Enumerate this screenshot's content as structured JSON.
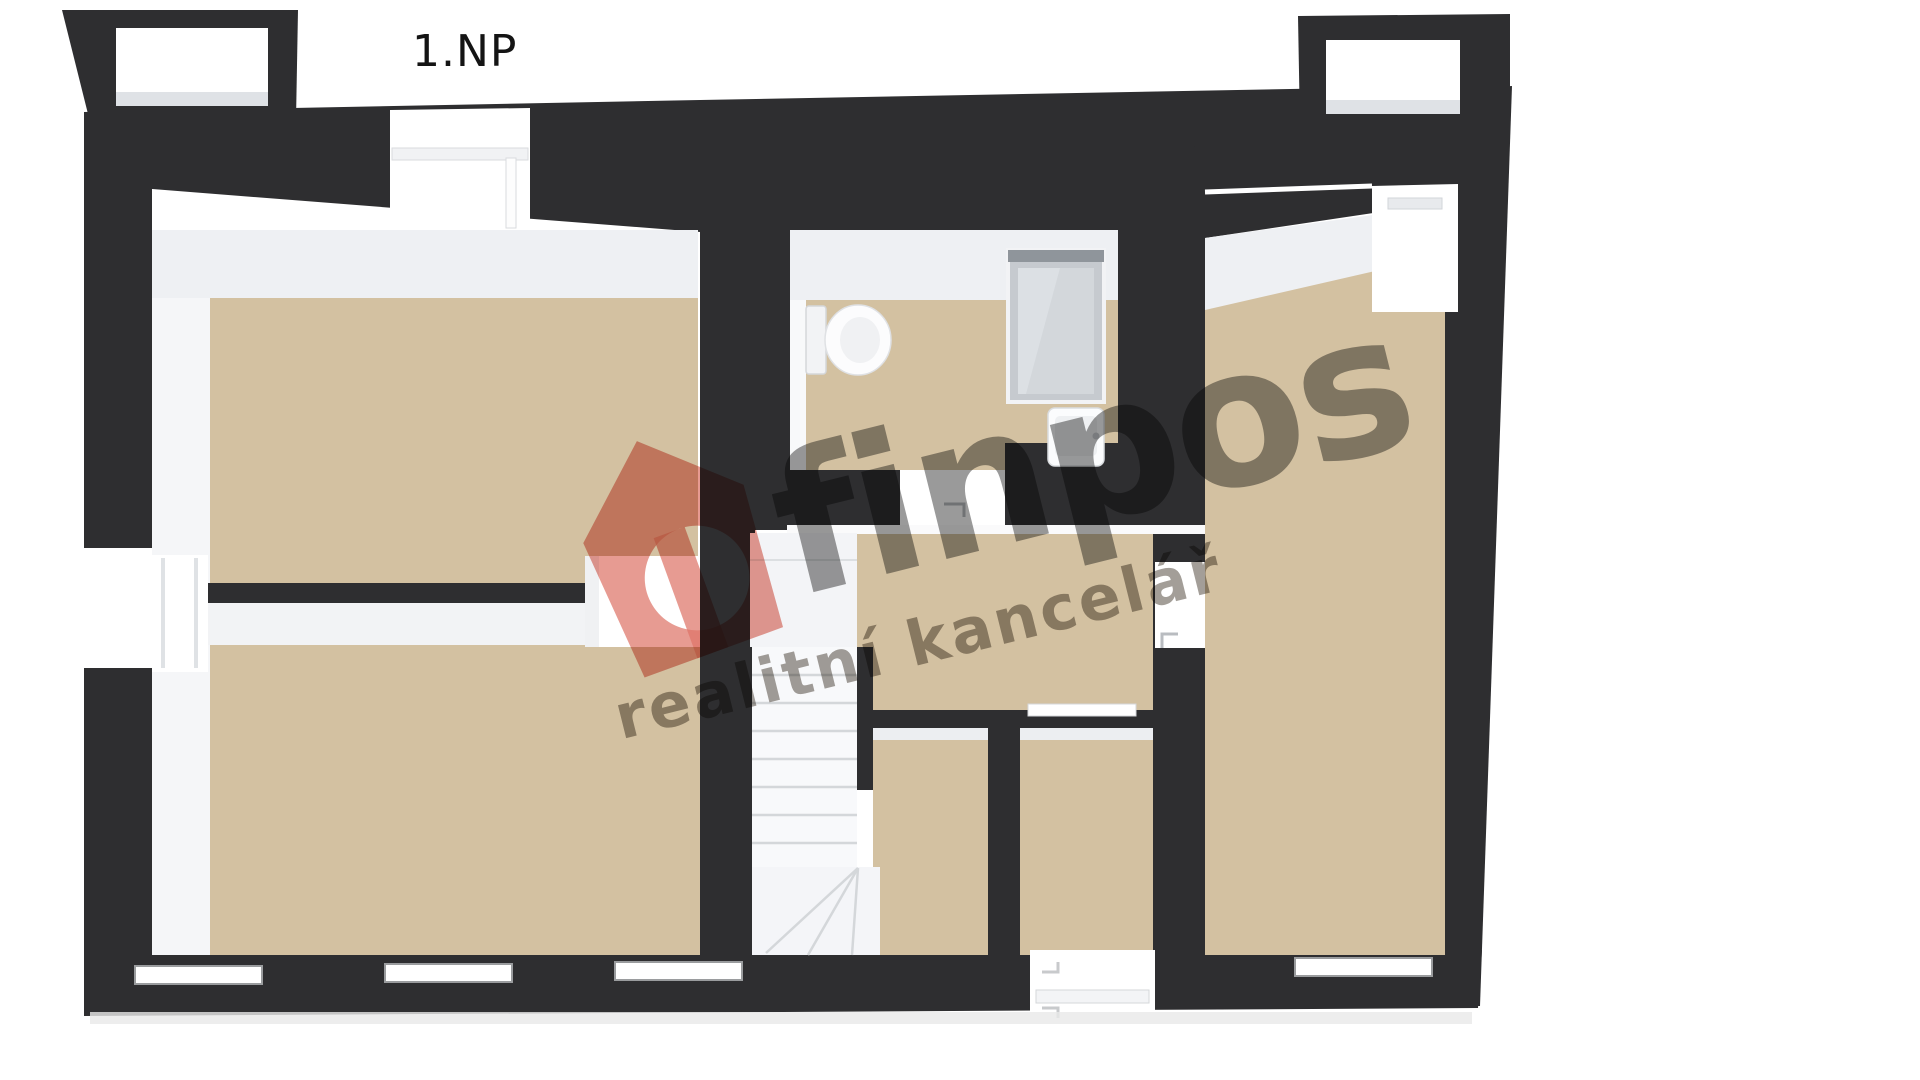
{
  "page": {
    "background": "#ffffff"
  },
  "floorplan": {
    "label": "1.NP",
    "colors": {
      "wall": "#2e2e30",
      "wall_face": "#eef0f3",
      "wall_white": "#ffffff",
      "floor": "#d3c1a1",
      "stair_tread": "#f8f9fb",
      "shower_glass": "#c6cacf",
      "ground_shadow": "#e9e9e9"
    }
  },
  "watermark": {
    "brand": "finpos",
    "tagline": "realitní kancelář",
    "colors": {
      "logo": "#de7468",
      "brand": "#3e3e3e",
      "tagline": "#6a6358"
    }
  }
}
